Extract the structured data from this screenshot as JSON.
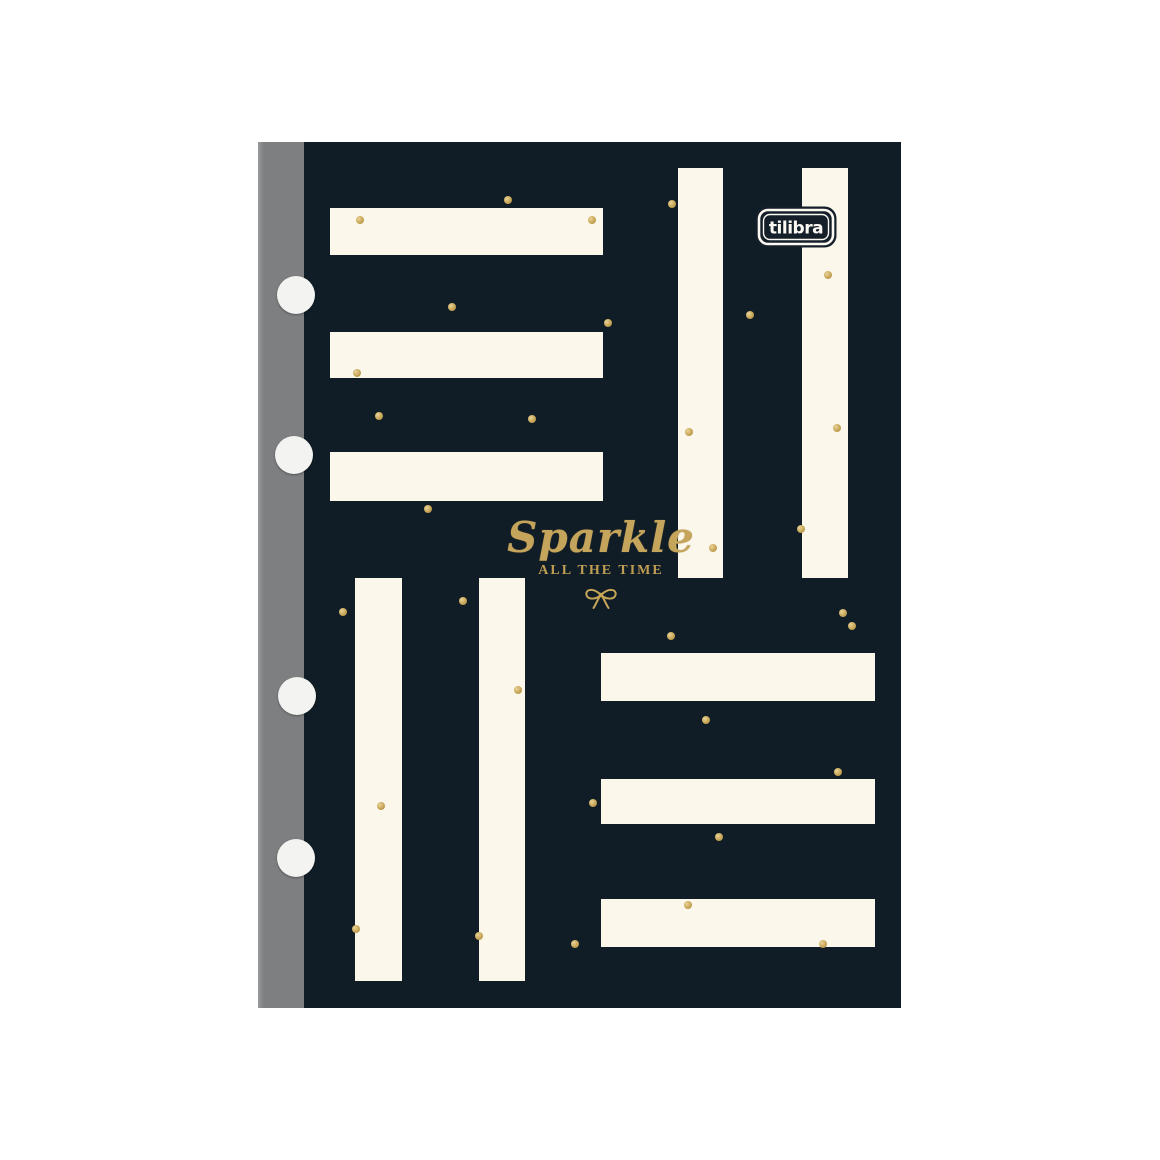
{
  "brand_logo": {
    "text": "tilibra"
  },
  "cover_text": {
    "title": "Sparkle",
    "subtitle": "ALL THE TIME",
    "bow_icon": "ribbon-bow-icon"
  },
  "colors": {
    "page_background": "#ffffff",
    "cover": "#101d27",
    "stripe_cream": "#fbf7eb",
    "spine_gray": "#7e7f81",
    "gold": "#c7a557",
    "hole_white": "#f3f3f1",
    "logo_text": "#fbf9f2"
  },
  "stripes": {
    "top_left_horizontal": [
      {
        "x": 330,
        "y": 208,
        "w": 273,
        "h": 47
      },
      {
        "x": 330,
        "y": 332,
        "w": 273,
        "h": 46
      },
      {
        "x": 330,
        "y": 452,
        "w": 273,
        "h": 49
      }
    ],
    "top_right_vertical": [
      {
        "x": 678,
        "y": 168,
        "w": 45,
        "h": 410
      },
      {
        "x": 802,
        "y": 168,
        "w": 46,
        "h": 410
      }
    ],
    "bottom_left_vertical": [
      {
        "x": 355,
        "y": 578,
        "w": 47,
        "h": 403
      },
      {
        "x": 479,
        "y": 578,
        "w": 46,
        "h": 403
      }
    ],
    "bottom_right_horizontal": [
      {
        "x": 601,
        "y": 653,
        "w": 274,
        "h": 48
      },
      {
        "x": 601,
        "y": 779,
        "w": 274,
        "h": 45
      },
      {
        "x": 601,
        "y": 899,
        "w": 274,
        "h": 48
      }
    ]
  },
  "binder_holes": [
    {
      "x": 296,
      "y": 295
    },
    {
      "x": 294,
      "y": 455
    },
    {
      "x": 297,
      "y": 696
    },
    {
      "x": 296,
      "y": 858
    }
  ],
  "gold_dots": [
    [
      508,
      200
    ],
    [
      360,
      220
    ],
    [
      592,
      220
    ],
    [
      672,
      204
    ],
    [
      828,
      275
    ],
    [
      750,
      315
    ],
    [
      452,
      307
    ],
    [
      608,
      323
    ],
    [
      357,
      373
    ],
    [
      379,
      416
    ],
    [
      532,
      419
    ],
    [
      428,
      509
    ],
    [
      689,
      432
    ],
    [
      837,
      428
    ],
    [
      801,
      529
    ],
    [
      713,
      548
    ],
    [
      343,
      612
    ],
    [
      463,
      601
    ],
    [
      843,
      613
    ],
    [
      852,
      626
    ],
    [
      671,
      636
    ],
    [
      518,
      690
    ],
    [
      706,
      720
    ],
    [
      838,
      772
    ],
    [
      593,
      803
    ],
    [
      381,
      806
    ],
    [
      719,
      837
    ],
    [
      688,
      905
    ],
    [
      356,
      929
    ],
    [
      479,
      936
    ],
    [
      823,
      944
    ],
    [
      575,
      944
    ]
  ]
}
